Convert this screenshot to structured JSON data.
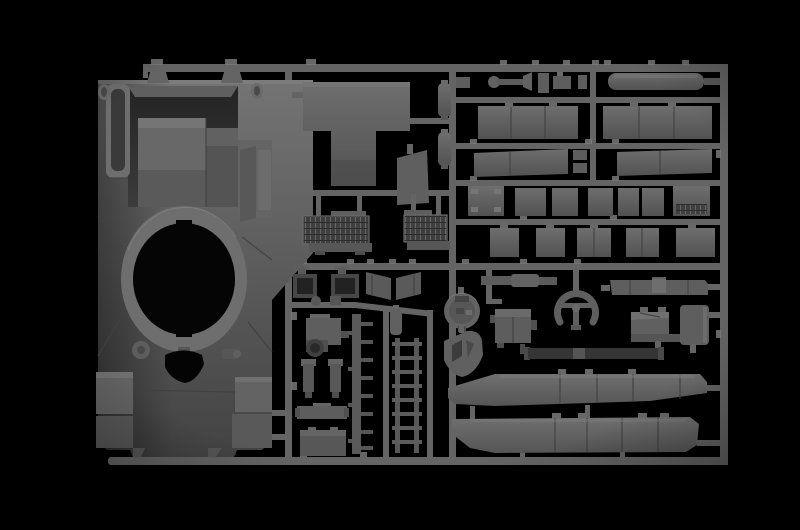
{
  "scene": {
    "type": "photograph",
    "description": "Macro product photo of a dark grey injection-moulded plastic model-kit sprue (parts tree for a tank model) lying on a pure black background, lit softly from above with a vignette toward the edges.",
    "alt": "Grey plastic model sprue on black background: large tank turret shell with circular ring opening at left, rows of flat hull panels at top right, engine grilles, hatches, track strips and two long side skirts at bottom right",
    "background": "black"
  },
  "palette": {
    "bg": "#000000",
    "rail": "#646464",
    "railLight": "#787878",
    "railDark": "#4a4a4a",
    "part": "#5d5d5d",
    "partLight": "#747474",
    "partLighter": "#868686",
    "partDark": "#454545",
    "interior": "#2e2e2e",
    "hole": "#050505",
    "skirt": "#6b6b6b",
    "grille": "#3f3f3f",
    "barDark": "#353535"
  },
  "parts": [
    {
      "id": "turret-shell",
      "label": "tank turret upper shell with circular ring opening"
    },
    {
      "id": "turret-ring-opening",
      "label": "round turret ring hole"
    },
    {
      "id": "triangle-opening",
      "label": "small rounded triangular opening"
    },
    {
      "id": "t-shaped-roof-part",
      "label": "T-shaped roof plate"
    },
    {
      "id": "engine-grilles",
      "label": "two mesh engine intake grilles"
    },
    {
      "id": "smoke-launcher-cylinders",
      "label": "two cylindrical parts"
    },
    {
      "id": "hull-panels",
      "label": "rows of rectangular hull and hatch panels"
    },
    {
      "id": "gun-barrel-bar",
      "label": "long rounded bar part"
    },
    {
      "id": "round-hatch",
      "label": "circular hatch part"
    },
    {
      "id": "triangular-bracket",
      "label": "rounded triangular bracket"
    },
    {
      "id": "horseshoe-wheel",
      "label": "horseshoe shaped wheel with cross"
    },
    {
      "id": "track-strips",
      "label": "vertical ladder-like track strips"
    },
    {
      "id": "dark-torsion-bar",
      "label": "long dark bar"
    },
    {
      "id": "side-skirt-upper",
      "label": "upper long side skirt"
    },
    {
      "id": "side-skirt-lower",
      "label": "lower long side skirt"
    }
  ]
}
